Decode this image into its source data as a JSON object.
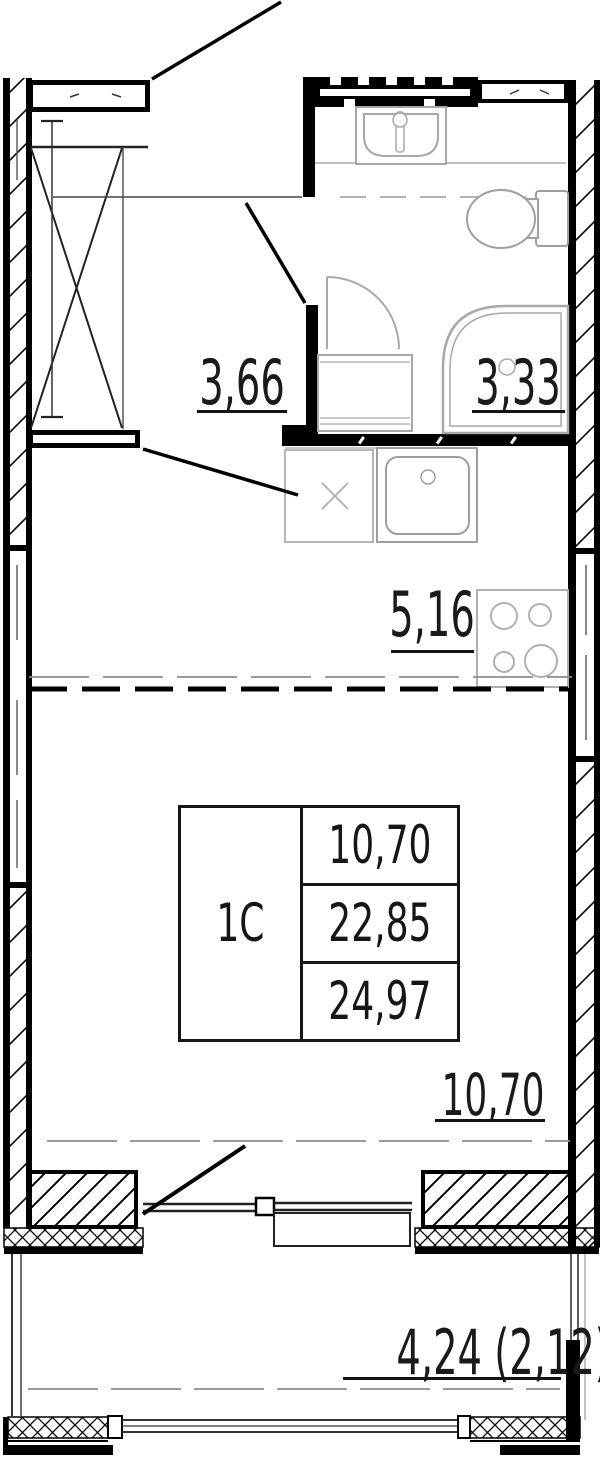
{
  "labels": {
    "hallway_area": "3,66",
    "bathroom_area": "3,33",
    "kitchen_area": "5,16",
    "room_area": "10,70",
    "balcony_area": "4,24 (2,12)"
  },
  "info_table": {
    "unit_type": "1С",
    "living_area": "10,70",
    "apartment_area": "22,85",
    "total_area": "24,97"
  },
  "colors": {
    "wall": "#000000",
    "fixture_stroke": "#a8a8a8",
    "zone_line_gray": "#8c8c8c",
    "text": "#1a1a1a"
  },
  "fixtures": [
    "wardrobe",
    "bathroom-sink",
    "toilet",
    "shower",
    "washing-machine",
    "bathroom-door",
    "kitchen-sink",
    "appliance-slot",
    "stove",
    "balcony-door",
    "window",
    "vent-shaft"
  ]
}
